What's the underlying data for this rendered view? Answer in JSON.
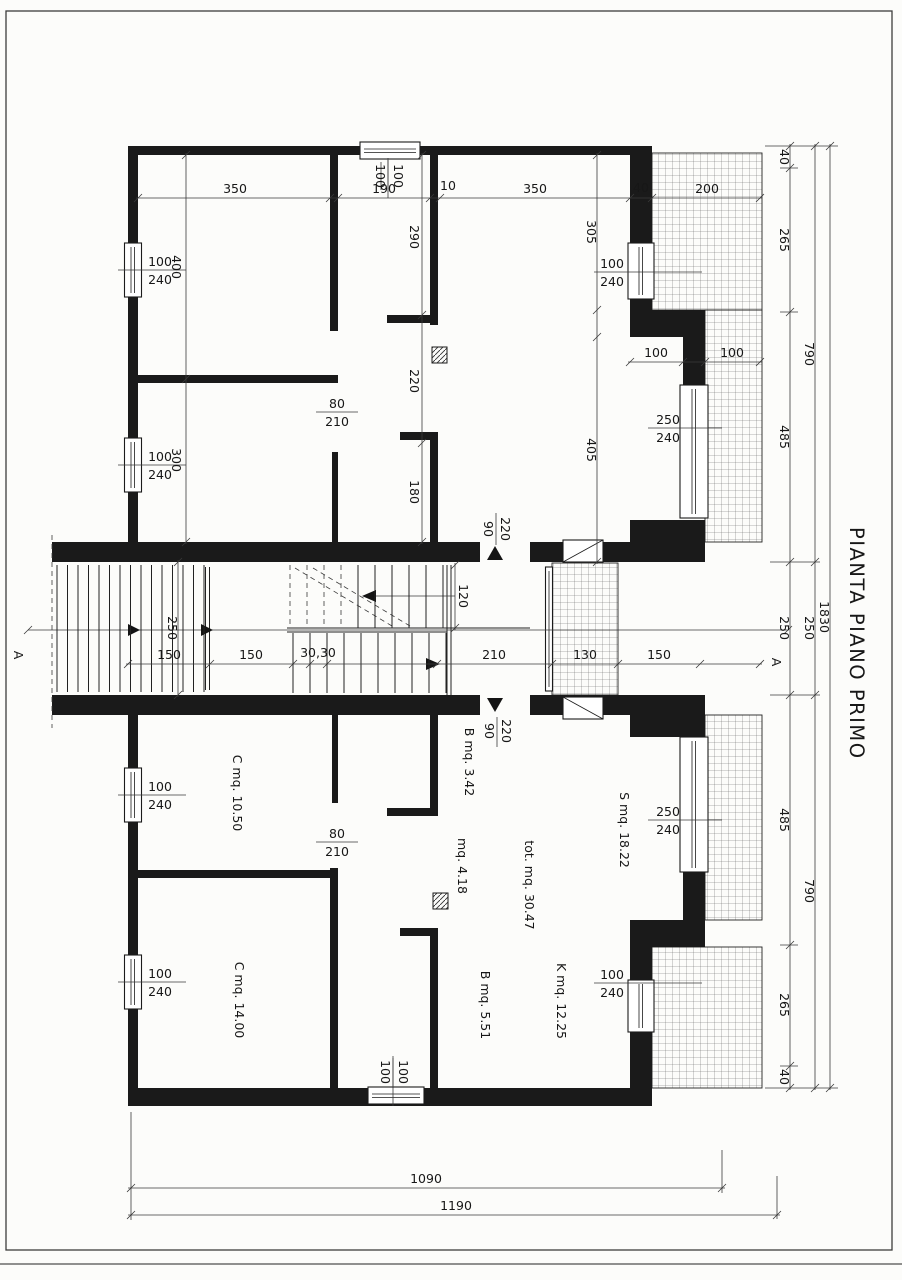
{
  "title": "PIANTA PIANO PRIMO",
  "section_label": "A",
  "upper": {
    "top_dims": [
      "350",
      "190",
      "10",
      "350",
      "40",
      "200"
    ],
    "left_dims": [
      "400",
      "300"
    ],
    "mid_dims": [
      "290",
      "220",
      "180"
    ],
    "right_dims": [
      "305",
      "405"
    ],
    "step_dims": [
      "100",
      "100"
    ]
  },
  "stair": {
    "corridor_width": "250",
    "flight_width": "120",
    "dims": [
      "150",
      "150",
      "30,30",
      "210",
      "130",
      "150"
    ]
  },
  "lower": {
    "rooms": {
      "c1": "C mq. 10.50",
      "b1": "B mq. 3.42",
      "disimpegno": "mq. 4.18",
      "soggiorno": "S mq. 18.22",
      "totale": "tot. mq. 30.47",
      "c2": "C mq. 14.00",
      "b2": "B mq. 5.51",
      "kitchen": "K mq. 12.25"
    }
  },
  "openings": {
    "win_100_240": {
      "num": "100",
      "den": "240"
    },
    "win_250_240": {
      "num": "250",
      "den": "240"
    },
    "win_100_100": {
      "num": "100",
      "den": "100"
    },
    "door_80_210": {
      "num": "80",
      "den": "210"
    },
    "door_90_220": {
      "num": "90",
      "den": "220"
    }
  },
  "right_chain": {
    "inner": [
      "40",
      "265",
      "485",
      "250",
      "485",
      "265",
      "40"
    ],
    "middle": [
      "790",
      "250",
      "790"
    ],
    "outer": "1830"
  },
  "bottom_dims": [
    "1090",
    "1190"
  ]
}
